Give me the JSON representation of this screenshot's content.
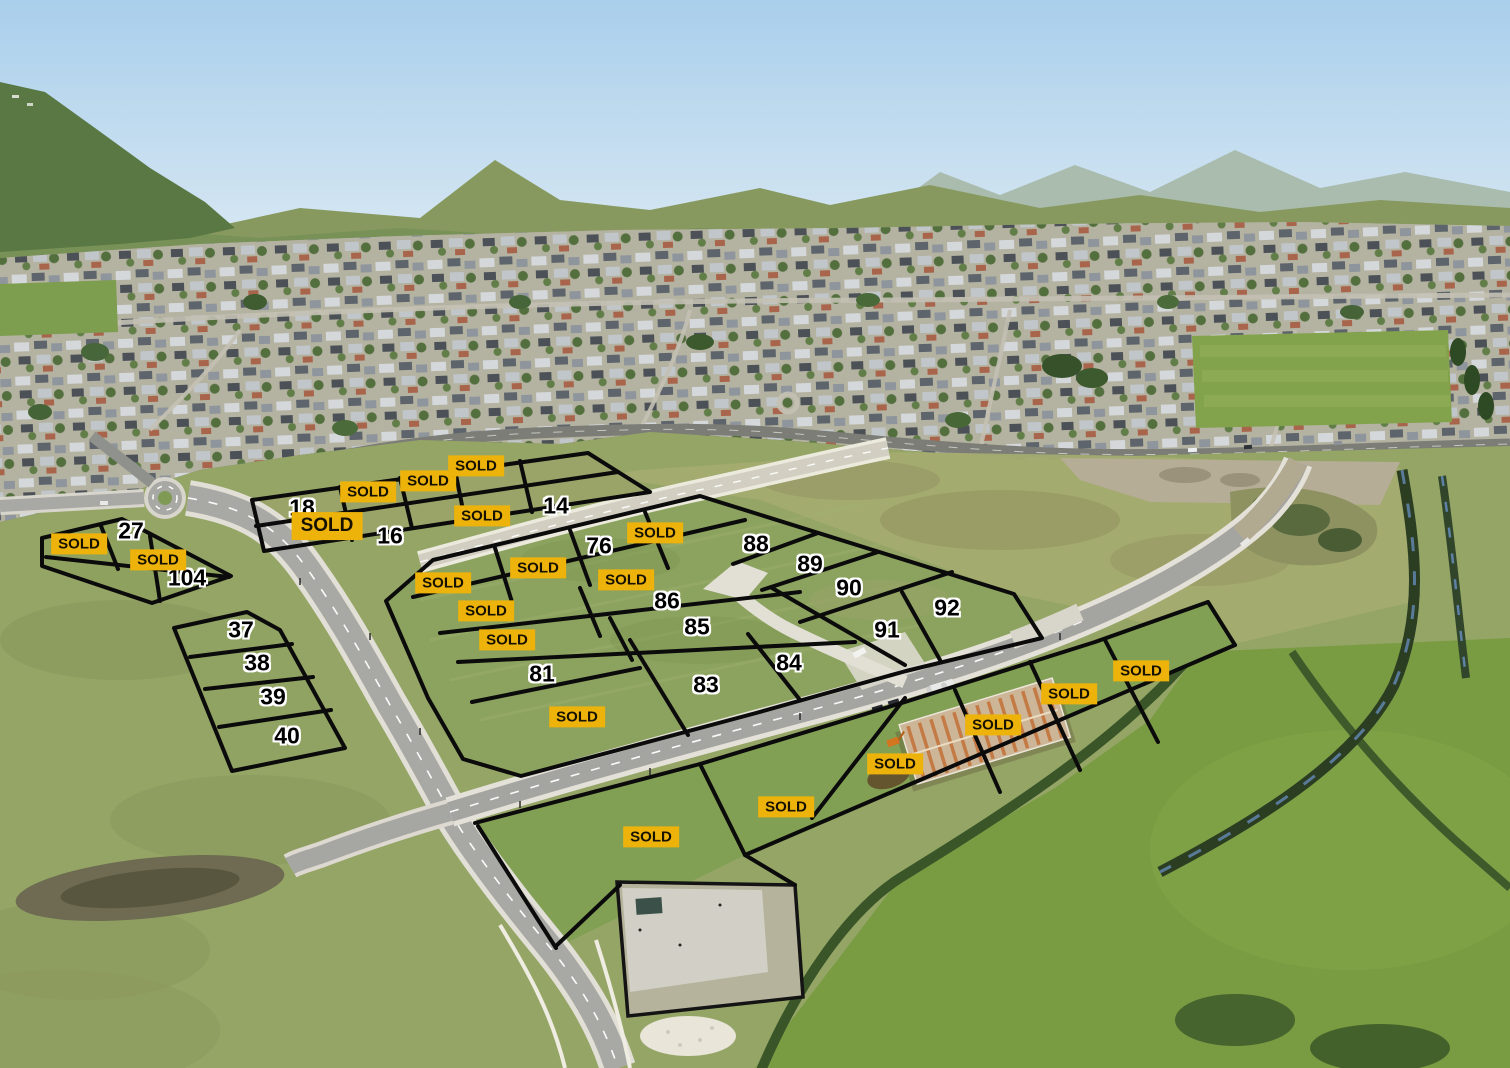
{
  "labels": {
    "sold_text": "SOLD"
  },
  "colors": {
    "sold_bg": "#EDB30B",
    "sold_text": "#171200",
    "lot_number_text": "#000000",
    "lot_number_halo": "#FFFFFF",
    "boundary_line": "#0B0B0B"
  },
  "available_lots": [
    {
      "number": "27",
      "x": 131,
      "y": 531
    },
    {
      "number": "104",
      "x": 187,
      "y": 578
    },
    {
      "number": "18",
      "x": 302,
      "y": 508
    },
    {
      "number": "16",
      "x": 390,
      "y": 536
    },
    {
      "number": "14",
      "x": 556,
      "y": 506
    },
    {
      "number": "76",
      "x": 599,
      "y": 546
    },
    {
      "number": "88",
      "x": 756,
      "y": 544
    },
    {
      "number": "89",
      "x": 810,
      "y": 564
    },
    {
      "number": "90",
      "x": 849,
      "y": 588
    },
    {
      "number": "92",
      "x": 947,
      "y": 608
    },
    {
      "number": "91",
      "x": 887,
      "y": 630
    },
    {
      "number": "86",
      "x": 667,
      "y": 601
    },
    {
      "number": "85",
      "x": 697,
      "y": 627
    },
    {
      "number": "84",
      "x": 789,
      "y": 663
    },
    {
      "number": "83",
      "x": 706,
      "y": 685
    },
    {
      "number": "81",
      "x": 542,
      "y": 674
    },
    {
      "number": "37",
      "x": 241,
      "y": 630
    },
    {
      "number": "38",
      "x": 257,
      "y": 663
    },
    {
      "number": "39",
      "x": 273,
      "y": 697
    },
    {
      "number": "40",
      "x": 287,
      "y": 736
    }
  ],
  "sold_lots": [
    {
      "x": 79,
      "y": 544,
      "size": "normal"
    },
    {
      "x": 158,
      "y": 560,
      "size": "normal"
    },
    {
      "x": 327,
      "y": 526,
      "size": "large"
    },
    {
      "x": 368,
      "y": 492,
      "size": "normal"
    },
    {
      "x": 428,
      "y": 481,
      "size": "normal"
    },
    {
      "x": 476,
      "y": 466,
      "size": "normal"
    },
    {
      "x": 482,
      "y": 516,
      "size": "normal"
    },
    {
      "x": 655,
      "y": 533,
      "size": "normal"
    },
    {
      "x": 626,
      "y": 580,
      "size": "normal"
    },
    {
      "x": 538,
      "y": 568,
      "size": "normal"
    },
    {
      "x": 443,
      "y": 583,
      "size": "normal"
    },
    {
      "x": 486,
      "y": 611,
      "size": "normal"
    },
    {
      "x": 507,
      "y": 640,
      "size": "normal"
    },
    {
      "x": 577,
      "y": 717,
      "size": "normal"
    },
    {
      "x": 1141,
      "y": 671,
      "size": "normal"
    },
    {
      "x": 1069,
      "y": 694,
      "size": "normal"
    },
    {
      "x": 993,
      "y": 725,
      "size": "normal"
    },
    {
      "x": 895,
      "y": 764,
      "size": "normal"
    },
    {
      "x": 786,
      "y": 807,
      "size": "normal"
    },
    {
      "x": 651,
      "y": 837,
      "size": "normal"
    }
  ]
}
